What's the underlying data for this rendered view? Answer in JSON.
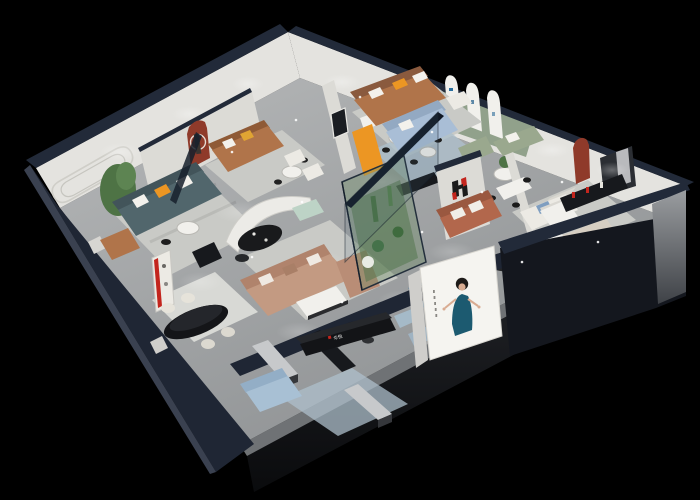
{
  "scene": {
    "type": "3d-isometric-cutaway-render",
    "description": "Dollhouse view of a furniture showroom interior on a black background",
    "brand": {
      "logo_mark": "H",
      "logo_text": "华悦",
      "desk_sign_text": "华悦"
    },
    "poster": {
      "subject": "model in teal evening dress",
      "background": "#f5f4f0"
    },
    "rooms": [
      {
        "name": "upper-left-lounge",
        "items": "caramel leather sofa, red arched niche with sculpture, round table with chairs"
      },
      {
        "name": "left-living-room",
        "items": "teal sofa with orange pillows, tall plant, round coffee table, caramel armchair"
      },
      {
        "name": "upper-middle-display",
        "items": "brown leather sofa, ring-light sculpture, orange chaise, cafe tables"
      },
      {
        "name": "arched-gallery",
        "items": "sage wall with three white arches, blue sofa, media console"
      },
      {
        "name": "right-suite",
        "items": "cream sofas, dining table, black wall console with red books, red niche, curtained window"
      },
      {
        "name": "center-gallery",
        "items": "curved white partition, black oval table, blush sectional, glass plant terrarium"
      },
      {
        "name": "front-corridor",
        "items": "black reception desk with brand sign, blue poufs, display benches, light blue sofa"
      },
      {
        "name": "bottom-left-dining",
        "items": "black oval dining table, cream chairs, red framed shelf"
      }
    ]
  },
  "colors": {
    "background": "#000000",
    "wall_top": "#222a39",
    "wall_face": "#e4e3df",
    "floor_light": "#b2b4b5",
    "floor_dark": "#8d9092",
    "platform_grey": "#6f7275",
    "sage_wall": "#91a18b",
    "brand_red": "#c3251d",
    "logo_black": "#1b1b1b",
    "accent_orange": "#ec9623",
    "niche_red": "#8f3a2a",
    "sofa_caramel": "#b0744a",
    "sofa_teal": "#51666c",
    "sofa_blush": "#c39a82",
    "sofa_blue": "#a9bed6",
    "sofa_slate": "#6f8ba0",
    "sofa_terracotta": "#b2674c",
    "sofa_cream": "#eceae4",
    "pouf_blue": "#a5bac8",
    "terrarium_green": "#6f8f66",
    "plant_green": "#4e7345",
    "glass_dark": "#101824",
    "desk_black": "#131417",
    "poster_bg": "#f5f4f0",
    "poster_dress": "#1c5a70",
    "skin": "#d9ac92"
  }
}
